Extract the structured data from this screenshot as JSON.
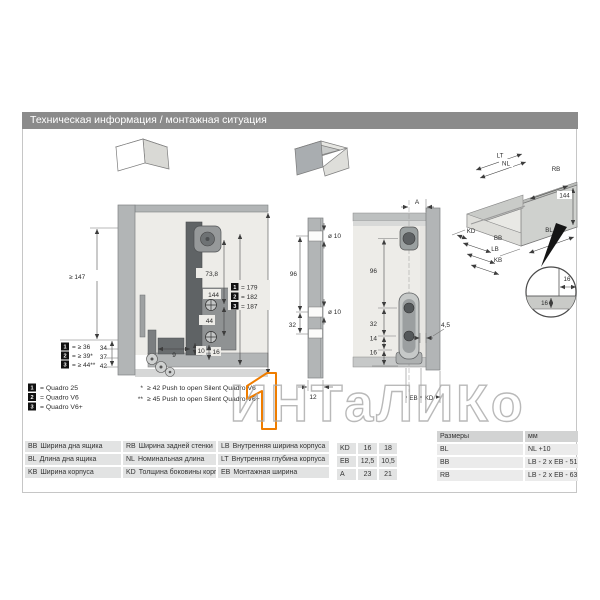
{
  "page": {
    "title": "Техническая информация / монтажная ситуация"
  },
  "watermark": {
    "text": "ИНТаЛИКо",
    "accent_orange": "#ef7d00"
  },
  "side_view": {
    "dim_height_min": "≥ 147",
    "stack": [
      "34",
      "37",
      "42"
    ],
    "depth_variants": [
      {
        "id": "1",
        "value": "= ≥ 36"
      },
      {
        "id": "2",
        "value": "= ≥ 39*"
      },
      {
        "id": "3",
        "value": "= ≥ 44**"
      }
    ],
    "dim_73_8": "73,8",
    "dim_44": "44",
    "dim_144": "144",
    "height_variants": [
      {
        "id": "1",
        "value": "= 179"
      },
      {
        "id": "2",
        "value": "= 182"
      },
      {
        "id": "3",
        "value": "= 187"
      }
    ],
    "dim_9": "9",
    "dim_10": "10",
    "dim_16": "16"
  },
  "front_panel": {
    "dim_hole_top": "ø 10",
    "dim_96": "96",
    "dim_hole_mid": "ø 10",
    "dim_32": "32",
    "dim_12": "12"
  },
  "rear_view": {
    "dim_a": "A",
    "dim_96": "96",
    "dim_32": "32",
    "dim_14": "14",
    "dim_16": "16",
    "dim_4_5": "4,5",
    "dim_eb": "EB",
    "dim_kd": "KD"
  },
  "iso_view": {
    "lt": "LT",
    "nl": "NL",
    "rb": "RB",
    "h144": "144",
    "kd": "KD",
    "bb": "BB",
    "lb": "LB",
    "kb": "KB",
    "bl": "BL",
    "detail_w": "16",
    "detail_h": "16"
  },
  "legend": {
    "variants": [
      {
        "id": "1",
        "label": "= Quadro 25"
      },
      {
        "id": "2",
        "label": "= Quadro V6"
      },
      {
        "id": "3",
        "label": "= Quadro V6+"
      }
    ],
    "notes": [
      {
        "mark": "*",
        "text": "≥ 42 Push to open Silent Quadro V6"
      },
      {
        "mark": "**",
        "text": "≥ 45 Push to open Silent Quadro V6+"
      }
    ]
  },
  "abbrev_table": {
    "rows": [
      [
        {
          "code": "BB",
          "desc": "Ширина дна ящика"
        },
        {
          "code": "RB",
          "desc": "Ширина задней стенки"
        },
        {
          "code": "LB",
          "desc": "Внутренняя ширина корпуса"
        }
      ],
      [
        {
          "code": "BL",
          "desc": "Длина дна ящика"
        },
        {
          "code": "NL",
          "desc": "Номинальная длина"
        },
        {
          "code": "LT",
          "desc": "Внутренняя глубина корпуса"
        }
      ],
      [
        {
          "code": "KB",
          "desc": "Ширина корпуса"
        },
        {
          "code": "KD",
          "desc": "Толщина боковины корпуса"
        },
        {
          "code": "EB",
          "desc": "Монтажная ширина"
        }
      ]
    ]
  },
  "values_table": {
    "rows": [
      [
        "KD",
        "16",
        "18"
      ],
      [
        "EB",
        "12,5",
        "10,5"
      ],
      [
        "A",
        "23",
        "21"
      ]
    ]
  },
  "dims_table": {
    "header": [
      "Размеры",
      "мм"
    ],
    "rows": [
      [
        "BL",
        "NL +10"
      ],
      [
        "BB",
        "LB - 2 x EB - 51,5"
      ],
      [
        "RB",
        "LB - 2 x EB - 63"
      ]
    ]
  }
}
